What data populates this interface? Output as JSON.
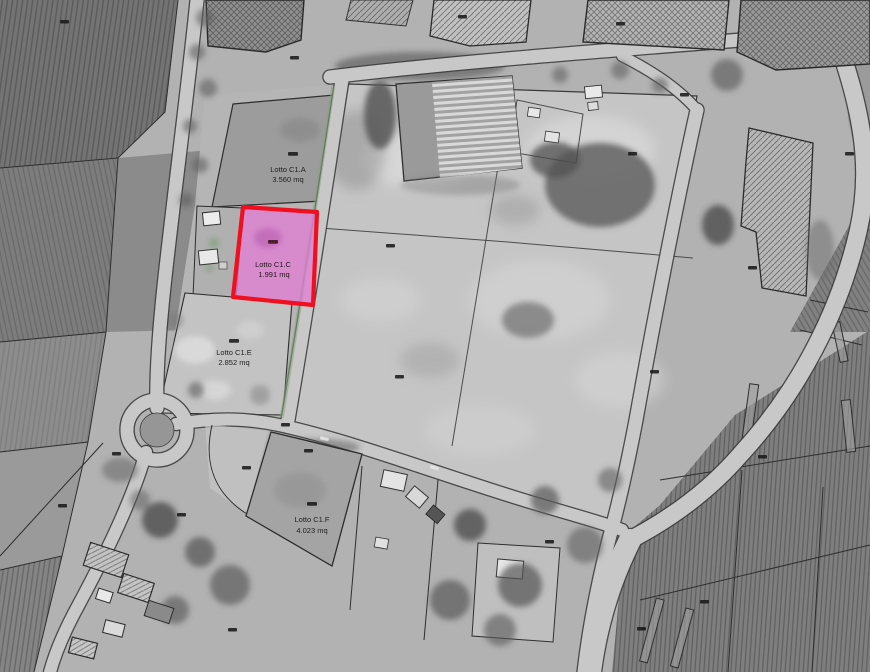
{
  "map": {
    "lots": [
      {
        "id": "lotto-c1a",
        "name": "Lotto C1.A",
        "area": "3.560 mq"
      },
      {
        "id": "lotto-c1c",
        "name": "Lotto C1.C",
        "area": "1.991 mq"
      },
      {
        "id": "lotto-c1e",
        "name": "Lotto C1.E",
        "area": "2.852 mq"
      },
      {
        "id": "lotto-c1f",
        "name": "Lotto C1.F",
        "area": "4.023 mq"
      }
    ],
    "colors": {
      "highlight_fill": "#e07fd4",
      "highlight_stroke": "#ef0f1f",
      "cadastral_line": "#2d2d2d"
    }
  }
}
